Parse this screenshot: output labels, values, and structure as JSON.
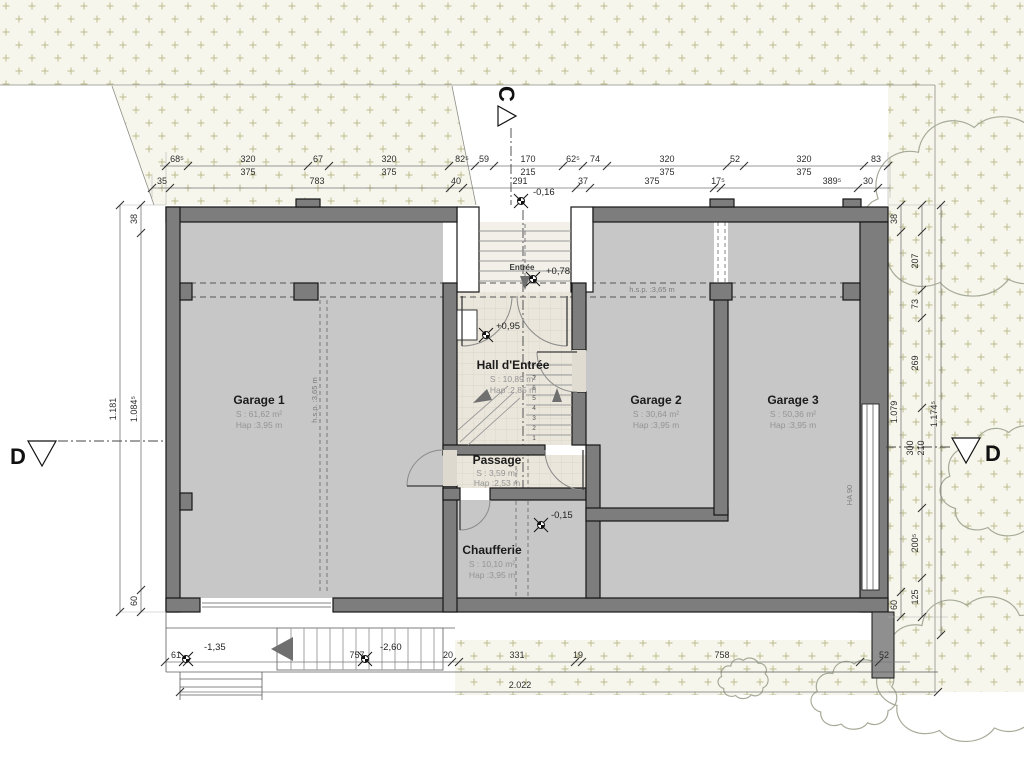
{
  "plan": {
    "rooms": [
      {
        "name": "Garage 1",
        "area": "S : 61,62 m²",
        "height": "Hap :3,95 m"
      },
      {
        "name": "Garage 2",
        "area": "S : 30,64 m²",
        "height": "Hap :3,95 m"
      },
      {
        "name": "Garage 3",
        "area": "S : 50,36 m²",
        "height": "Hap :3,95 m"
      },
      {
        "name": "Hall d'Entrée",
        "area": "S : 10,89 m²",
        "height": "Hap :2,85 m"
      },
      {
        "name": "Passage",
        "area": "S : 3,59 m²",
        "height": "Hap :2,53 m"
      },
      {
        "name": "Chaufferie",
        "area": "S : 10,10 m²",
        "height": "Hap :3,95 m"
      },
      {
        "name": "Entrée"
      }
    ],
    "levels": [
      "-0,16",
      "+0,78",
      "+0,95",
      "-0,15",
      "-1,35",
      "-2,60"
    ],
    "sections": {
      "c": "C",
      "d": "D"
    },
    "notes": {
      "hsp": "h.s.p. :3,65 m",
      "window": "HA 90"
    },
    "stair_numbers": [
      "1",
      "2",
      "3",
      "4",
      "5",
      "6",
      "7"
    ],
    "dims": {
      "top1": [
        "68⁵",
        "320",
        "375",
        "67",
        "320",
        "375",
        "82⁵",
        "59",
        "170",
        "215",
        "62⁵",
        "74",
        "320",
        "375",
        "52",
        "320",
        "375",
        "83"
      ],
      "top2": [
        "35",
        "783",
        "40",
        "291",
        "37",
        "375",
        "17⁵",
        "389⁵",
        "30"
      ],
      "left": [
        "38",
        "1.181",
        "1.084⁵",
        "60"
      ],
      "right": [
        "38",
        "207",
        "73",
        "269",
        "300",
        "210",
        "200⁵",
        "125",
        "60",
        "1.079",
        "1.174⁵"
      ],
      "bottom": [
        "61",
        "757",
        "20",
        "331",
        "19",
        "758",
        "52"
      ],
      "total": "2.022"
    }
  }
}
